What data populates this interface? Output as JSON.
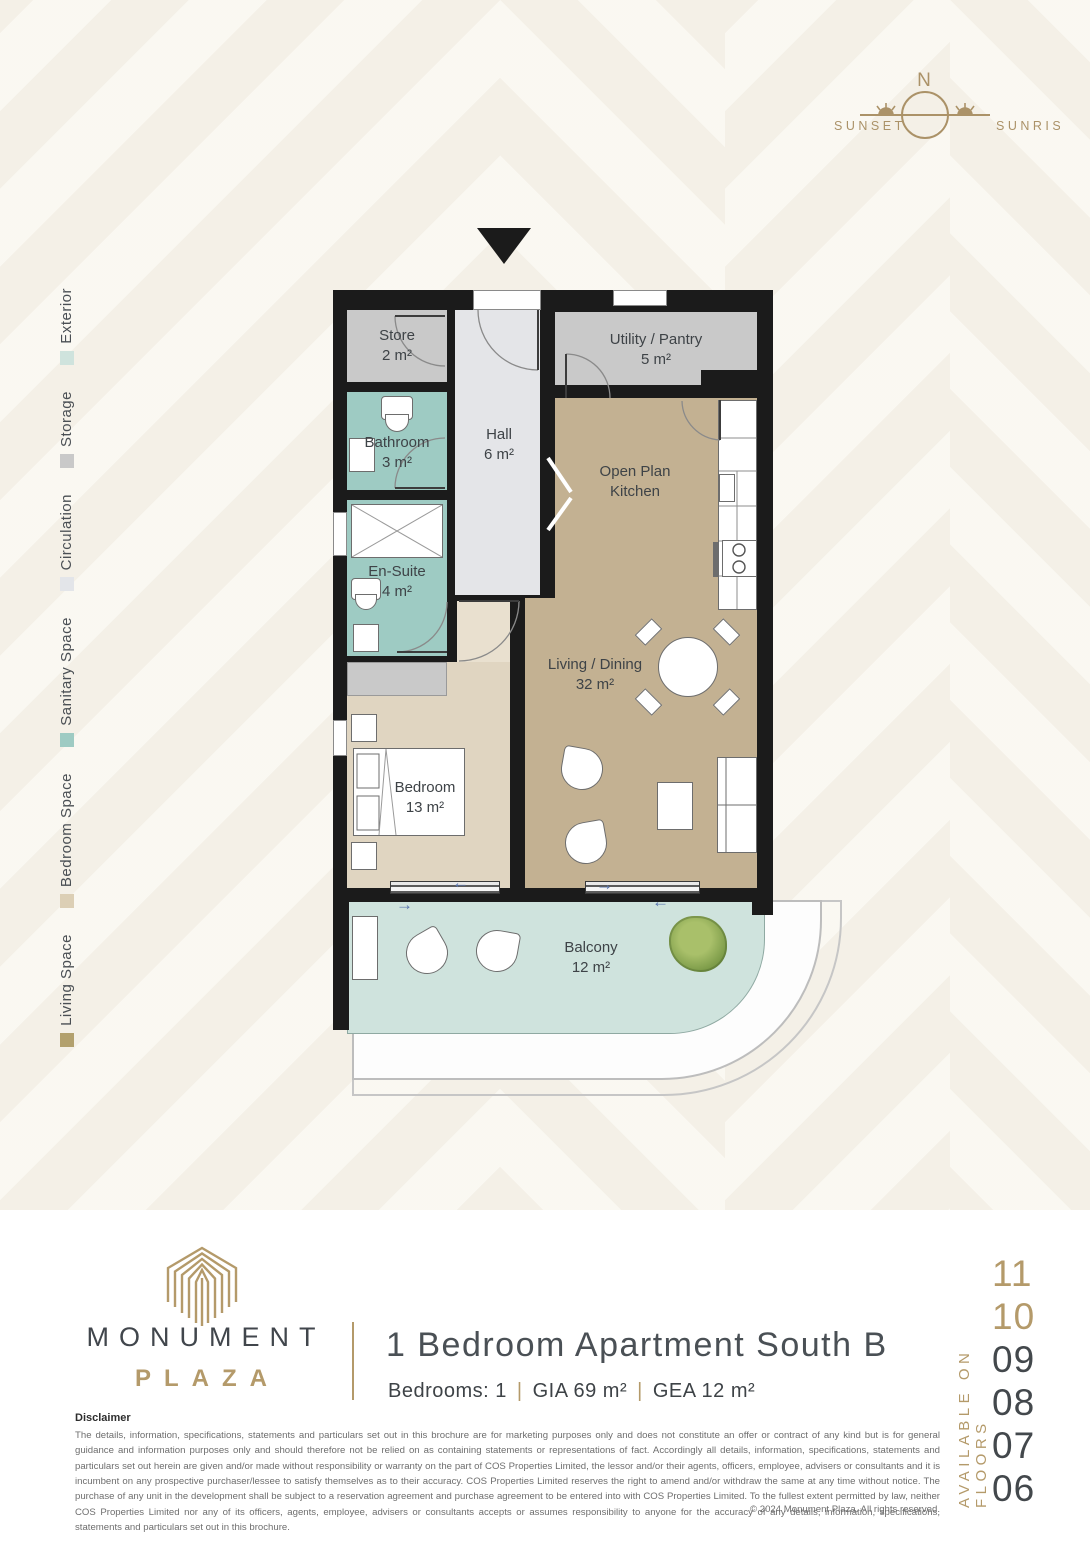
{
  "colors": {
    "accent": "#b49a6a",
    "dark_text": "#41464c",
    "wall": "#1b1b1b"
  },
  "compass": {
    "north": "N",
    "sunset": "SUNSET",
    "sunrise": "SUNRISE"
  },
  "legend": {
    "items": [
      {
        "label": "Exterior",
        "color": "#cfe3dd"
      },
      {
        "label": "Storage",
        "color": "#c9c9c9"
      },
      {
        "label": "Circulation",
        "color": "#e3e5e9"
      },
      {
        "label": "Sanitary Space",
        "color": "#9ecbc3"
      },
      {
        "label": "Bedroom Space",
        "color": "#dccfb5"
      },
      {
        "label": "Living Space",
        "color": "#b2a06d"
      }
    ]
  },
  "floorplan": {
    "palette": {
      "wall": "#1b1b1b",
      "storage": "#c9c9c9",
      "circulation": "#e4e5e8",
      "sanitary": "#9ecbc3",
      "bedroom": "#e0d5c1",
      "vestibule": "#e9e0cf",
      "living": "#c3b192",
      "balcony": "#cfe3dd"
    },
    "rooms": {
      "store": {
        "name": "Store",
        "area": "2 m²"
      },
      "utility": {
        "name": "Utility / Pantry",
        "area": "5 m²"
      },
      "bathroom": {
        "name": "Bathroom",
        "area": "3 m²"
      },
      "hall": {
        "name": "Hall",
        "area": "6 m²"
      },
      "ensuite": {
        "name": "En-Suite",
        "area": "4 m²"
      },
      "kitchen": {
        "line1": "Open Plan",
        "line2": "Kitchen"
      },
      "living": {
        "name": "Living / Dining",
        "area": "32 m²"
      },
      "bedroom": {
        "name": "Bedroom",
        "area": "13 m²"
      },
      "balcony": {
        "name": "Balcony",
        "area": "12 m²"
      }
    }
  },
  "icons": {
    "arrow_left": "←",
    "arrow_right": "→"
  },
  "branding": {
    "name": "MONUMENT",
    "sub": "PLAZA"
  },
  "unit": {
    "title": "1 Bedroom Apartment South B",
    "bedrooms": "Bedrooms: 1",
    "gia": "GIA 69 m²",
    "gea": "GEA 12 m²",
    "separator": "|"
  },
  "availability": {
    "label": "AVAILABLE ON FLOORS",
    "floors": [
      {
        "num": "11",
        "color": "#b49a6a"
      },
      {
        "num": "10",
        "color": "#b49a6a"
      },
      {
        "num": "09",
        "color": "#43484c"
      },
      {
        "num": "08",
        "color": "#43484c"
      },
      {
        "num": "07",
        "color": "#43484c"
      },
      {
        "num": "06",
        "color": "#43484c"
      }
    ]
  },
  "disclaimer": {
    "heading": "Disclaimer",
    "body": "The details, information, specifications, statements and particulars set out in this brochure are for marketing purposes only and does not constitute an offer or contract of any kind but is for general guidance and information purposes only and should therefore not be relied on as containing statements or representations of fact. Accordingly all details, information, specifications, statements and particulars set out herein are given and/or made without responsibility or warranty on the part of COS Properties Limited, the lessor and/or their agents, officers, employee, advisers or consultants and it is incumbent on any prospective purchaser/lessee to satisfy themselves as to their accuracy. COS Properties Limited reserves the right to amend and/or withdraw the same at any time without notice. The purchase of any unit in the development shall be subject to a reservation agreement and purchase agreement to be entered into with COS Properties Limited. To the fullest extent permitted by law, neither COS Properties Limited nor any of its officers, agents, employee, advisers or consultants accepts or assumes responsibility to anyone for the accuracy of any details, information, specifications, statements and particulars set out in this brochure.",
    "copyright": "© 2024   Monument Plaza. All rights reserved."
  }
}
